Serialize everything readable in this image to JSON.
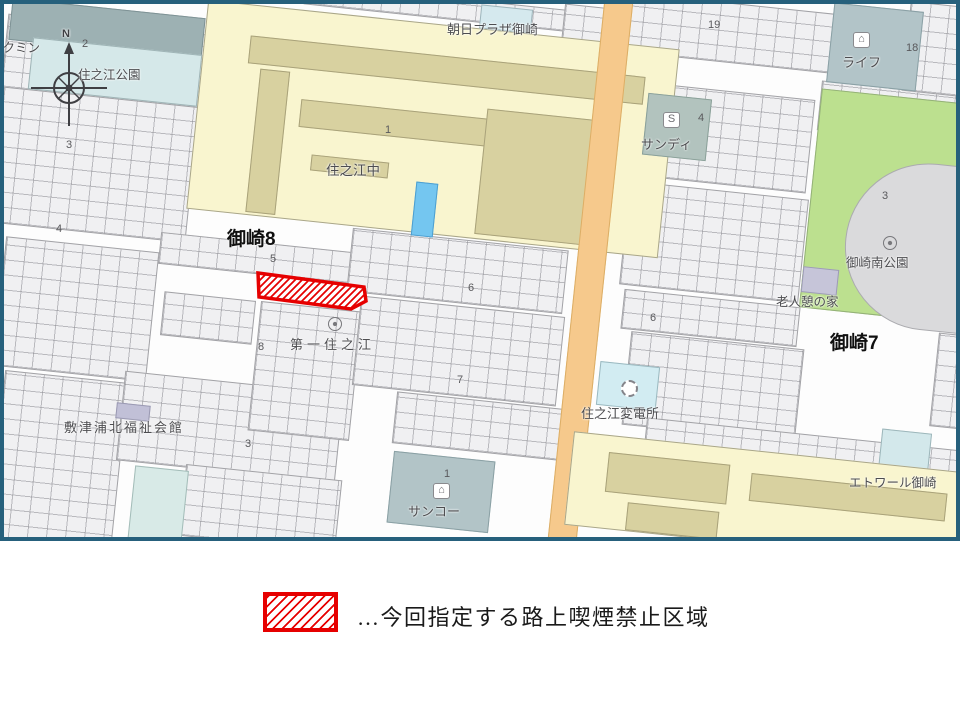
{
  "colors": {
    "map_border": "#26607c",
    "road_orange": "#f6c98c",
    "school_yellow": "#f9f5cf",
    "park_green": "#bce08f",
    "pool_blue": "#74c6f0",
    "zone_red": "#e60000",
    "store_teal": "#b3c4c7"
  },
  "map": {
    "labels": {
      "kokumin": "コクミン",
      "suminoe_park": "住之江公園",
      "asahi_plaza": "朝日プラザ御崎",
      "suminoe_junior_high": "住之江中",
      "life": "ライフ",
      "sandy": "サンディ",
      "misaki_minami_park": "御崎南公園",
      "misaki8": "御崎8",
      "misaki7": "御崎7",
      "daiichi_suminoe": "第一住之江",
      "rojin_ikoi_no_ie": "老人憩の家",
      "shikitsuura_kita_fukushi_kaikan": "敷津浦北福祉会館",
      "suminoe_substation": "住之江変電所",
      "sanko": "サンコー",
      "etoile_misaki": "エトワール御崎",
      "compass_north": "N"
    },
    "numbers": [
      "2",
      "3",
      "4",
      "1",
      "5",
      "6",
      "8",
      "7",
      "19",
      "18",
      "4",
      "3",
      "6",
      "3",
      "1"
    ],
    "icons": {
      "store_glyph": "⌂",
      "sandy_glyph": "S"
    }
  },
  "legend": {
    "description": "…今回指定する路上喫煙禁止区域"
  }
}
